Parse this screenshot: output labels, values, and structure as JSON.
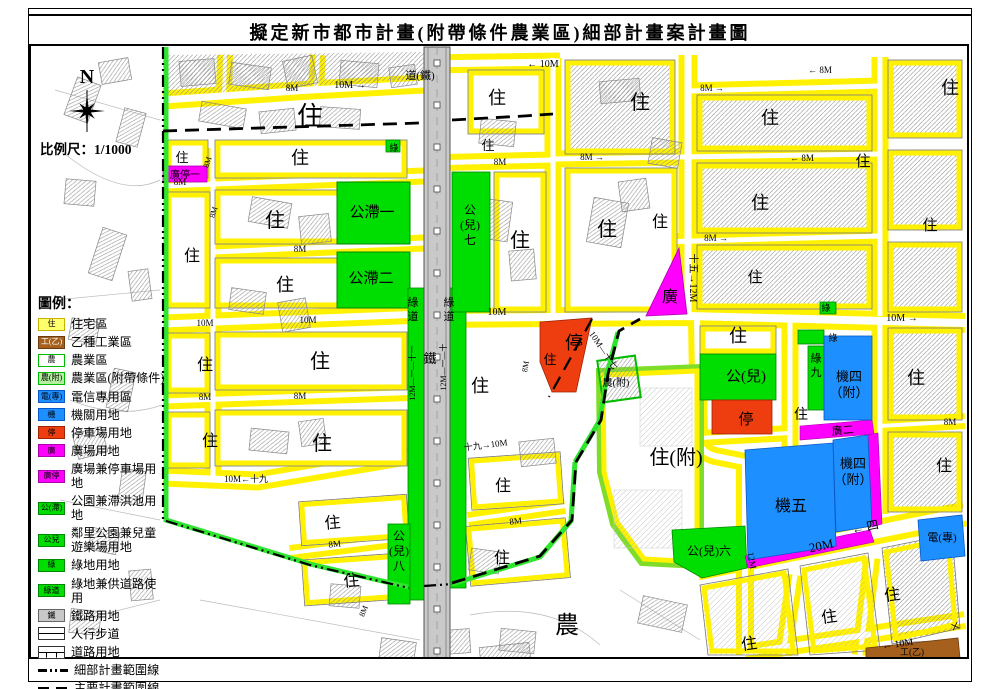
{
  "title": "擬定新市都市計畫(附帶條件農業區)細部計畫案計畫圖",
  "north_label": "N",
  "scale_label": "比例尺：1/1000",
  "legend": {
    "heading": "圖例：",
    "items": [
      {
        "type": "fill",
        "swatch": "住",
        "label": "住宅區",
        "fill": "#ffff6e",
        "border": "#c8b400",
        "text": "#000"
      },
      {
        "type": "fill",
        "swatch": "工(乙)",
        "label": "乙種工業區",
        "fill": "#a5601e",
        "border": "#6d3c0e",
        "text": "#fff"
      },
      {
        "type": "fill",
        "swatch": "農",
        "label": "農業區",
        "fill": "#ffffff",
        "border": "#00bb00",
        "text": "#000"
      },
      {
        "type": "fill",
        "swatch": "農(附)",
        "label": "農業區(附帶條件)",
        "fill": "#b4f0a0",
        "border": "#00bb00",
        "text": "#000"
      },
      {
        "type": "fill",
        "swatch": "電(專)",
        "label": "電信專用區",
        "fill": "#1e8fff",
        "border": "#0a58c8",
        "text": "#000"
      },
      {
        "type": "fill",
        "swatch": "機",
        "label": "機關用地",
        "fill": "#1e8fff",
        "border": "#0a58c8",
        "text": "#000"
      },
      {
        "type": "fill",
        "swatch": "停",
        "label": "停車場用地",
        "fill": "#ee3d0f",
        "border": "#9e2404",
        "text": "#000"
      },
      {
        "type": "fill",
        "swatch": "廣",
        "label": "廣場用地",
        "fill": "#ff00ff",
        "border": "#aa00aa",
        "text": "#000"
      },
      {
        "type": "fill",
        "swatch": "廣停",
        "label": "廣場兼停車場用地",
        "fill": "#ff00ff",
        "border": "#aa00aa",
        "text": "#000"
      },
      {
        "type": "fill",
        "swatch": "公(滯)",
        "label": "公園兼滯洪池用地",
        "fill": "#00dd00",
        "border": "#008800",
        "text": "#000"
      },
      {
        "type": "fill",
        "swatch": "公兒",
        "label": "鄰里公園兼兒童\n遊樂場用地",
        "fill": "#00dd00",
        "border": "#008800",
        "text": "#000"
      },
      {
        "type": "fill",
        "swatch": "綠",
        "label": "綠地用地",
        "fill": "#00dd00",
        "border": "#008800",
        "text": "#000"
      },
      {
        "type": "fill",
        "swatch": "綠道",
        "label": "綠地兼供道路使用",
        "fill": "#00dd00",
        "border": "#008800",
        "text": "#000"
      },
      {
        "type": "fill",
        "swatch": "鐵",
        "label": "鐵路用地",
        "fill": "#c8c8c8",
        "border": "#666666",
        "text": "#000"
      },
      {
        "type": "sidewalk",
        "swatch": "",
        "label": "人行步道"
      },
      {
        "type": "road",
        "swatch": "",
        "label": "道路用地"
      },
      {
        "type": "line-dashdot",
        "swatch": "",
        "label": "細部計畫範圍線"
      },
      {
        "type": "line-dash",
        "swatch": "",
        "label": "主要計畫範圍線"
      }
    ]
  },
  "map": {
    "labels": [
      {
        "t": "住",
        "x": 310,
        "y": 125,
        "s": 26
      },
      {
        "t": "住",
        "x": 182,
        "y": 162,
        "s": 13
      },
      {
        "t": "住",
        "x": 300,
        "y": 164,
        "s": 18
      },
      {
        "t": "廣停一",
        "x": 185,
        "y": 178,
        "s": 10
      },
      {
        "t": "住",
        "x": 275,
        "y": 227,
        "s": 20
      },
      {
        "t": "住",
        "x": 192,
        "y": 261,
        "s": 16
      },
      {
        "t": "住",
        "x": 285,
        "y": 291,
        "s": 18
      },
      {
        "t": "公滯一",
        "x": 372,
        "y": 217,
        "s": 15
      },
      {
        "t": "公滯二",
        "x": 371,
        "y": 283,
        "s": 15
      },
      {
        "t": "住",
        "x": 205,
        "y": 370,
        "s": 16
      },
      {
        "t": "住",
        "x": 320,
        "y": 368,
        "s": 20
      },
      {
        "t": "住",
        "x": 210,
        "y": 446,
        "s": 16
      },
      {
        "t": "住",
        "x": 322,
        "y": 450,
        "s": 20
      },
      {
        "t": "住",
        "x": 333,
        "y": 528,
        "s": 16,
        "r": -5
      },
      {
        "t": "住",
        "x": 352,
        "y": 586,
        "s": 16,
        "r": -5
      },
      {
        "lines": [
          "公",
          "(兒)",
          "八"
        ],
        "x": 399,
        "y": 540,
        "s": 12
      },
      {
        "lines": [
          "綠",
          "道"
        ],
        "x": 413,
        "y": 306,
        "s": 11
      },
      {
        "lines": [
          "綠",
          "道"
        ],
        "x": 449,
        "y": 306,
        "s": 11
      },
      {
        "t": "鐵",
        "x": 430,
        "y": 363,
        "s": 13
      },
      {
        "lines": [
          "公",
          "(兒)",
          "七"
        ],
        "x": 470,
        "y": 214,
        "s": 12
      },
      {
        "t": "住",
        "x": 520,
        "y": 247,
        "s": 20
      },
      {
        "t": "住",
        "x": 497,
        "y": 104,
        "s": 18
      },
      {
        "t": "住",
        "x": 488,
        "y": 150,
        "s": 13
      },
      {
        "t": "住",
        "x": 607,
        "y": 236,
        "s": 20
      },
      {
        "t": "住",
        "x": 640,
        "y": 109,
        "s": 20
      },
      {
        "t": "住",
        "x": 660,
        "y": 227,
        "s": 16
      },
      {
        "t": "廣",
        "x": 670,
        "y": 302,
        "s": 16
      },
      {
        "t": "綠",
        "x": 394,
        "y": 151,
        "s": 9
      },
      {
        "t": "住",
        "x": 480,
        "y": 392,
        "s": 18
      },
      {
        "t": "住",
        "x": 550,
        "y": 364,
        "s": 13
      },
      {
        "t": "停",
        "x": 574,
        "y": 349,
        "s": 18
      },
      {
        "t": "農(附)",
        "x": 616,
        "y": 386,
        "s": 10
      },
      {
        "t": "住",
        "x": 503,
        "y": 491,
        "s": 16
      },
      {
        "t": "住",
        "x": 502,
        "y": 563,
        "s": 16
      },
      {
        "t": "農",
        "x": 567,
        "y": 633,
        "s": 24
      },
      {
        "t": "住(附)",
        "x": 676,
        "y": 464,
        "s": 20
      },
      {
        "t": "住",
        "x": 738,
        "y": 342,
        "s": 18
      },
      {
        "t": "公(兒)",
        "x": 746,
        "y": 381,
        "s": 15
      },
      {
        "t": "停",
        "x": 746,
        "y": 424,
        "s": 15
      },
      {
        "t": "住",
        "x": 801,
        "y": 419,
        "s": 14
      },
      {
        "lines": [
          "綠",
          "九"
        ],
        "x": 816,
        "y": 362,
        "s": 11
      },
      {
        "lines": [
          "機四",
          "（附）"
        ],
        "x": 849,
        "y": 381,
        "s": 13
      },
      {
        "t": "廣二",
        "x": 843,
        "y": 434,
        "s": 11,
        "r": -5
      },
      {
        "lines": [
          "機四",
          "（附）"
        ],
        "x": 853,
        "y": 468,
        "s": 13
      },
      {
        "t": "機五",
        "x": 791,
        "y": 511,
        "s": 16
      },
      {
        "t": "公(兒)六",
        "x": 709,
        "y": 555,
        "s": 12
      },
      {
        "t": "電(專)",
        "x": 942,
        "y": 541,
        "s": 11
      },
      {
        "t": "工(乙)",
        "x": 912,
        "y": 655,
        "s": 9
      },
      {
        "t": "住",
        "x": 770,
        "y": 124,
        "s": 18
      },
      {
        "t": "住",
        "x": 863,
        "y": 166,
        "s": 15
      },
      {
        "t": "住",
        "x": 760,
        "y": 209,
        "s": 18
      },
      {
        "t": "住",
        "x": 755,
        "y": 282,
        "s": 15
      },
      {
        "t": "住",
        "x": 950,
        "y": 94,
        "s": 18
      },
      {
        "t": "住",
        "x": 930,
        "y": 230,
        "s": 15
      },
      {
        "t": "住",
        "x": 916,
        "y": 384,
        "s": 18
      },
      {
        "t": "住",
        "x": 944,
        "y": 471,
        "s": 16
      },
      {
        "t": "住",
        "x": 893,
        "y": 600,
        "s": 16,
        "r": -8
      },
      {
        "t": "住",
        "x": 830,
        "y": 622,
        "s": 16,
        "r": -8
      },
      {
        "t": "住",
        "x": 750,
        "y": 649,
        "s": 16,
        "r": -8
      },
      {
        "t": "綠",
        "x": 826,
        "y": 311,
        "s": 9
      },
      {
        "t": "綠",
        "x": 833,
        "y": 341,
        "s": 9
      },
      {
        "t": "道(鐵)",
        "x": 420,
        "y": 79,
        "s": 11
      },
      {
        "t": "8M",
        "x": 292,
        "y": 91,
        "s": 9
      },
      {
        "t": "10M →",
        "x": 350,
        "y": 88,
        "s": 10
      },
      {
        "t": "← 10M",
        "x": 543,
        "y": 67,
        "s": 10
      },
      {
        "t": "8M →",
        "x": 712,
        "y": 91,
        "s": 9
      },
      {
        "t": "← 8M",
        "x": 820,
        "y": 73,
        "s": 9
      },
      {
        "t": "8M",
        "x": 500,
        "y": 165,
        "s": 9
      },
      {
        "t": "8M →",
        "x": 592,
        "y": 160,
        "s": 9
      },
      {
        "t": "← 8M",
        "x": 802,
        "y": 161,
        "s": 9
      },
      {
        "t": "8M →",
        "x": 716,
        "y": 241,
        "s": 9
      },
      {
        "t": "10M",
        "x": 205,
        "y": 326,
        "s": 9
      },
      {
        "t": "10M",
        "x": 308,
        "y": 323,
        "s": 9
      },
      {
        "t": "10M",
        "x": 497,
        "y": 315,
        "s": 10
      },
      {
        "t": "10M →",
        "x": 902,
        "y": 321,
        "s": 10
      },
      {
        "t": "8M",
        "x": 205,
        "y": 400,
        "s": 9
      },
      {
        "t": "8M",
        "x": 300,
        "y": 399,
        "s": 9
      },
      {
        "t": "8M",
        "x": 300,
        "y": 252,
        "s": 9
      },
      {
        "t": "8M",
        "x": 180,
        "y": 185,
        "s": 9
      },
      {
        "t": "8M",
        "x": 210,
        "y": 163,
        "s": 8,
        "r": -72
      },
      {
        "t": "8M",
        "x": 216,
        "y": 213,
        "s": 8,
        "r": -72
      },
      {
        "t": "10M←十九",
        "x": 246,
        "y": 482,
        "s": 9
      },
      {
        "t": "十九→10M",
        "x": 486,
        "y": 448,
        "s": 9,
        "r": -7
      },
      {
        "t": "10M—十七",
        "x": 601,
        "y": 352,
        "s": 9,
        "r": 56
      },
      {
        "t": "8M",
        "x": 528,
        "y": 367,
        "s": 8,
        "r": -80
      },
      {
        "t": "8M",
        "x": 335,
        "y": 547,
        "s": 9,
        "r": -6
      },
      {
        "t": "8M",
        "x": 366,
        "y": 612,
        "s": 8,
        "r": -68
      },
      {
        "t": "8M",
        "x": 516,
        "y": 524,
        "s": 9,
        "r": -7
      },
      {
        "t": "8M",
        "x": 950,
        "y": 425,
        "s": 9
      },
      {
        "t": "20M",
        "x": 822,
        "y": 550,
        "s": 13,
        "r": -12
      },
      {
        "t": "← 四",
        "x": 866,
        "y": 531,
        "s": 12,
        "r": -12
      },
      {
        "t": "← 10M",
        "x": 898,
        "y": 647,
        "s": 10,
        "r": -8
      },
      {
        "t": "十",
        "x": 959,
        "y": 628,
        "s": 10,
        "r": -65
      },
      {
        "t": "十五→12M",
        "x": 690,
        "y": 278,
        "s": 10,
        "r": 90
      },
      {
        "t": "12M—一—十一",
        "x": 415,
        "y": 373,
        "s": 8,
        "r": -90
      },
      {
        "t": "12M—一—十",
        "x": 446,
        "y": 367,
        "s": 8,
        "r": -90
      },
      {
        "t": "12M",
        "x": 749,
        "y": 561,
        "s": 9,
        "r": 80
      }
    ]
  }
}
